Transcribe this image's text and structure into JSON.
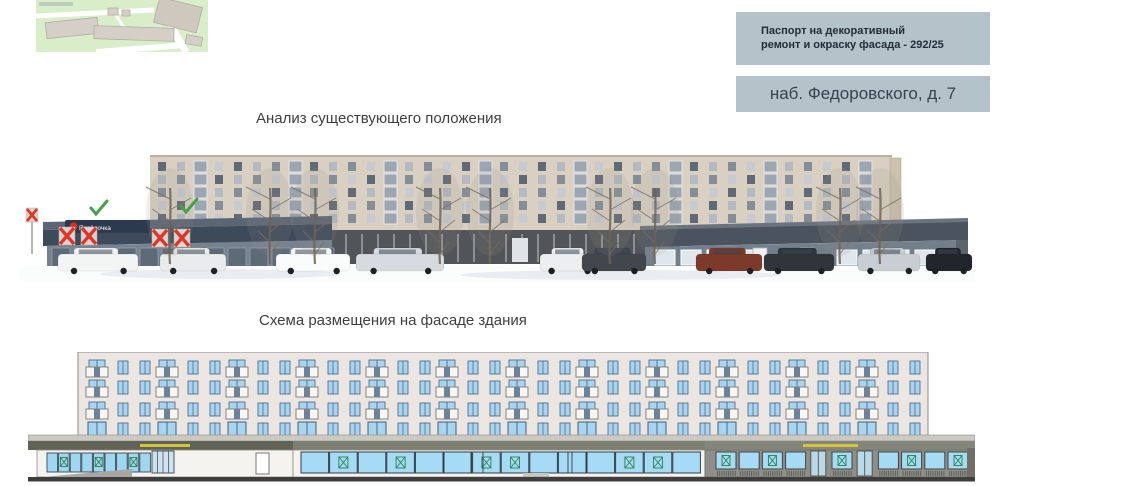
{
  "header": {
    "passport_box": {
      "lines": [
        "Паспорт на декоративный",
        "ремонт и окраску фасада - 292/25"
      ]
    },
    "address_box": {
      "text": "наб. Федоровского, д. 7"
    }
  },
  "sections": {
    "analysis_title": "Анализ существующего положения",
    "scheme_title": "Схема размещения на фасаде здания"
  },
  "colors": {
    "box_bg": "#b4c2ca",
    "box_text": "#222d38",
    "addr_text": "#36424d",
    "heading": "#3f3f3f",
    "annotation_check": "#46a24a",
    "annotation_x": "#e23327",
    "scheme_mark_green": "#2e8050",
    "scheme_window_blue": "#a8d4ef",
    "scheme_storefront_blue": "#a5dbf4",
    "scheme_facade": "#ece6e2",
    "canopy_sign_yellow": "#d4c438",
    "store_brand_red": "#d6321c"
  },
  "photo": {
    "store_sign_text": "Пятёрочка",
    "checks": [
      [
        78,
        58
      ],
      [
        168,
        56
      ]
    ],
    "x_marks": [
      [
        47,
        86
      ],
      [
        69,
        86
      ],
      [
        140,
        88
      ],
      [
        162,
        88
      ]
    ],
    "small_x_mark": [
      8,
      64
    ],
    "cars": [
      {
        "x": 38,
        "w": 80,
        "c": "#f3f4f4"
      },
      {
        "x": 140,
        "w": 66,
        "c": "#e9ebec"
      },
      {
        "x": 256,
        "w": 74,
        "c": "#fafbfb"
      },
      {
        "x": 336,
        "w": 88,
        "c": "#d7dade"
      },
      {
        "x": 520,
        "w": 58,
        "c": "#eceeef"
      },
      {
        "x": 562,
        "w": 64,
        "c": "#42474d"
      },
      {
        "x": 676,
        "w": 66,
        "c": "#7c3a2a"
      },
      {
        "x": 744,
        "w": 70,
        "c": "#30353c"
      },
      {
        "x": 838,
        "w": 62,
        "c": "#c9ced3"
      },
      {
        "x": 906,
        "w": 46,
        "c": "#22262c"
      }
    ],
    "trees": [
      150,
      250,
      295,
      420,
      470,
      590,
      635,
      820,
      860
    ]
  },
  "scheme": {
    "floors": 4,
    "balcony_units": 12,
    "left_storefront": {
      "pane_count": 9,
      "x_marks": [
        1,
        4,
        7
      ]
    },
    "mid_storefront": {
      "pane_count": 14,
      "x_marks": [
        1,
        3,
        6,
        7,
        11,
        12
      ]
    },
    "right_storefront": {
      "sequence": [
        "X",
        "P",
        "X",
        "P",
        "D",
        "X",
        "D",
        "P",
        "X",
        "P",
        "X"
      ]
    }
  }
}
